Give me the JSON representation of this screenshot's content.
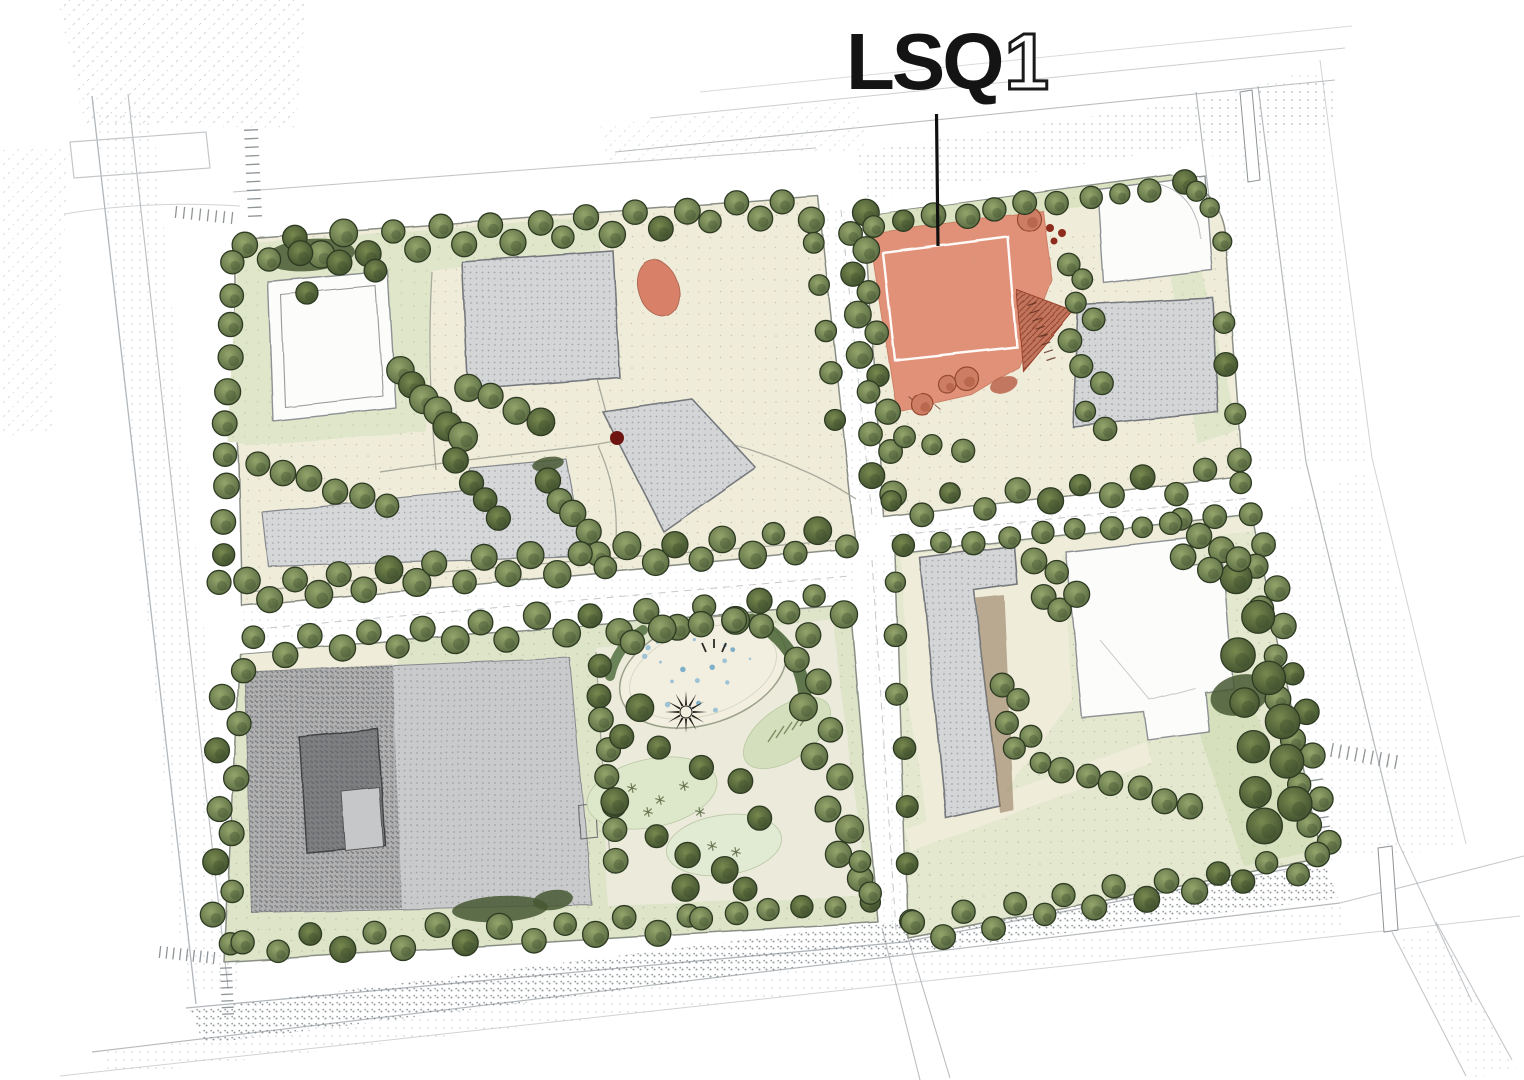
{
  "title": {
    "project": "LSQ",
    "unit": "1"
  },
  "callout": {
    "text": "LSQ1",
    "points_to": "highlighted-building"
  },
  "palette": {
    "ink": "#141414",
    "highlight_fill": "#e18a71",
    "highlight_outline": "#ffffff",
    "hatch_accent": "#c0755b",
    "ground_cream": "#f0ecda",
    "lawn_green": "#dfe6c9",
    "tree_green": "#6d7d4c",
    "building_gray": "#d4d5d7",
    "building_dark_gray": "#8f9092",
    "building_white": "#fcfcfb",
    "pond_fill": "#f2efe0",
    "water_speckle": "#9fc3d6",
    "fountain_ink": "#1d1c16",
    "accent_red_dot": "#6e1512",
    "road_line": "#a9aeb2"
  },
  "features": [
    "highlighted-building",
    "inner-footprint-outline",
    "white-building",
    "gray-building",
    "central-park",
    "pond",
    "fountain-starburst",
    "lawn-oval",
    "tree",
    "road",
    "crosswalk",
    "median-island"
  ]
}
